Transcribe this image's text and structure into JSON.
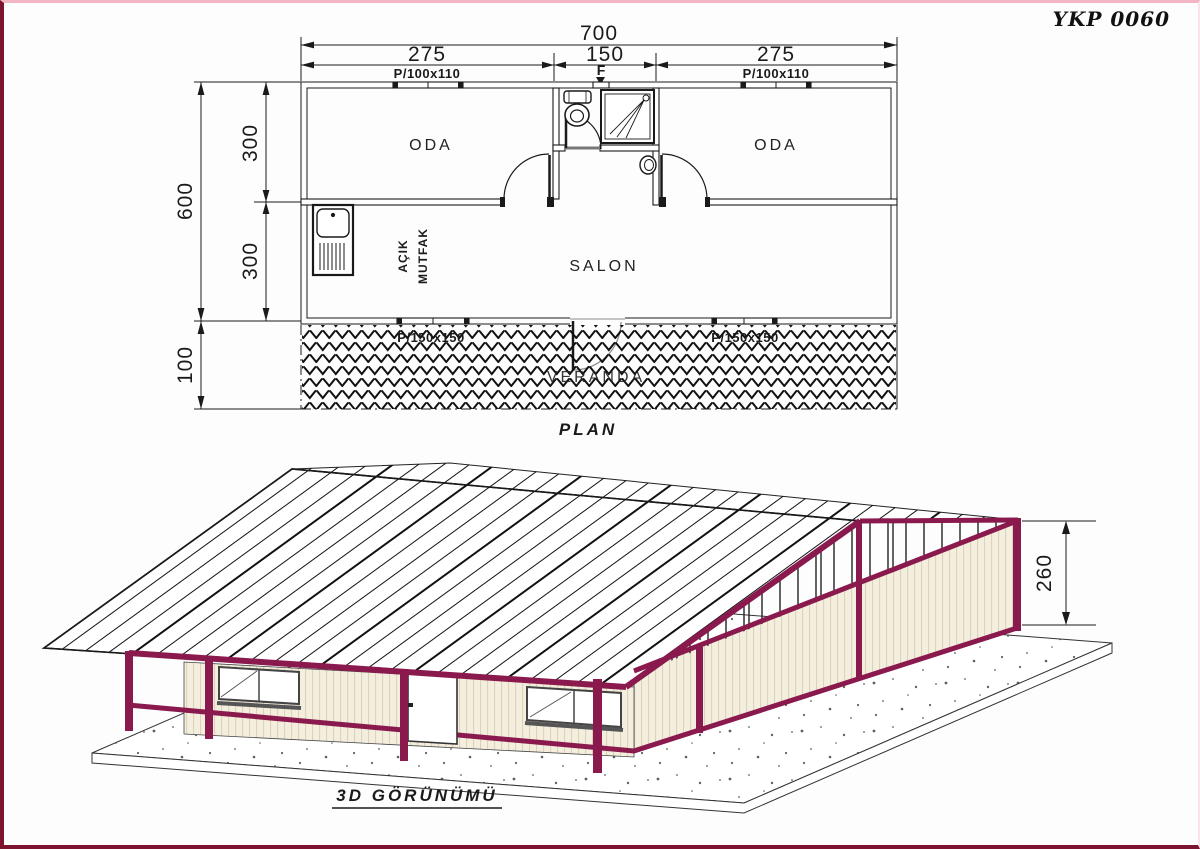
{
  "doc": {
    "code": "YKP 0060"
  },
  "plan": {
    "title": "PLAN",
    "rooms": {
      "room_left": "ODA",
      "room_right": "ODA",
      "living": "SALON",
      "veranda": "VERANDA",
      "kitchen_line1": "AÇIK",
      "kitchen_line2": "MUTFAK"
    },
    "dims": {
      "total_width": "700",
      "left_span": "275",
      "mid_span": "150",
      "right_span": "275",
      "total_depth": "600",
      "depth_upper": "300",
      "depth_lower": "300",
      "veranda_depth": "100"
    },
    "labels": {
      "window_top_left": "P/100x110",
      "window_top_right": "P/100x110",
      "f_mark": "F",
      "window_bottom_left": "P/150x150",
      "window_bottom_right": "P/150x150"
    }
  },
  "view3d": {
    "title": "3D GÖRÜNÜMÜ",
    "height_dim": "260"
  },
  "colors": {
    "frame": "#8a1a4e",
    "wall": "#f4eede",
    "wall_stripe": "#dcd3ba",
    "border_dark": "#7c1430",
    "border_pink": "#f2b6c2"
  }
}
